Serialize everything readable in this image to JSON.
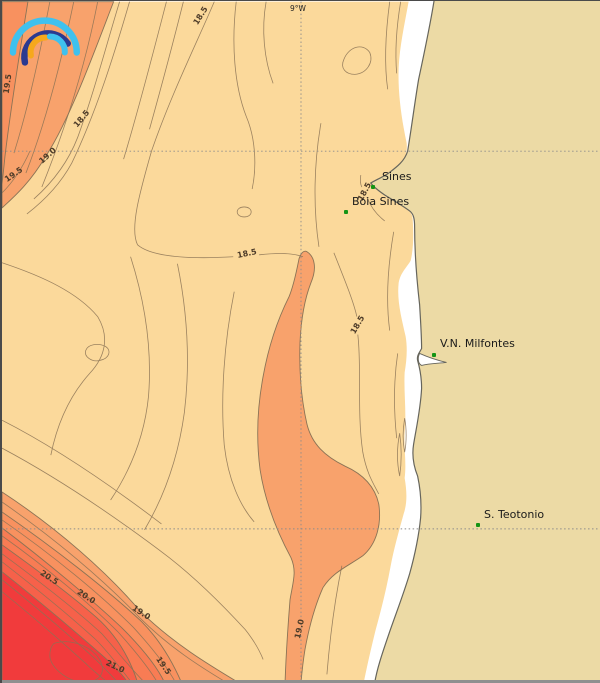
{
  "map": {
    "meridian_label": "9°W",
    "places": [
      {
        "name": "Sines",
        "marker_x": 371,
        "marker_y": 186,
        "label_x": 380,
        "label_y": 170
      },
      {
        "name": "Boia Sines",
        "marker_x": 344,
        "marker_y": 211,
        "label_x": 350,
        "label_y": 195
      },
      {
        "name": "V.N. Milfontes",
        "marker_x": 432,
        "marker_y": 354,
        "label_x": 438,
        "label_y": 337
      },
      {
        "name": "S. Teotonio",
        "marker_x": 476,
        "marker_y": 524,
        "label_x": 482,
        "label_y": 508
      }
    ],
    "contour_labels": [
      {
        "text": "19.5",
        "x": 6,
        "y": 83,
        "rot": -82
      },
      {
        "text": "18.5",
        "x": 199,
        "y": 15,
        "rot": -58
      },
      {
        "text": "18.5",
        "x": 80,
        "y": 118,
        "rot": -50
      },
      {
        "text": "19.0",
        "x": 46,
        "y": 155,
        "rot": -42
      },
      {
        "text": "19.5",
        "x": 12,
        "y": 174,
        "rot": -35
      },
      {
        "text": "18.5",
        "x": 245,
        "y": 253,
        "rot": -12
      },
      {
        "text": "18.5",
        "x": 363,
        "y": 191,
        "rot": -62
      },
      {
        "text": "18.5",
        "x": 356,
        "y": 324,
        "rot": -60
      },
      {
        "text": "20.5",
        "x": 47,
        "y": 577,
        "rot": 33
      },
      {
        "text": "20.0",
        "x": 84,
        "y": 596,
        "rot": 33
      },
      {
        "text": "19.0",
        "x": 139,
        "y": 612,
        "rot": 33
      },
      {
        "text": "21.0",
        "x": 113,
        "y": 666,
        "rot": 25
      },
      {
        "text": "19.5",
        "x": 161,
        "y": 665,
        "rot": 55
      },
      {
        "text": "19.0",
        "x": 298,
        "y": 628,
        "rot": -78
      }
    ],
    "colors": {
      "ocean_base": "#FBD99B",
      "band_19_0": "#F8A26C",
      "band_19_5": "#F8915F",
      "band_20_0": "#F87C54",
      "band_20_5": "#F6614A",
      "band_21_0": "#F13B3C",
      "land": "#ECDAA5",
      "nearshore_gap": "#FFFFFF",
      "coastline": "#66655C",
      "contour_line": "#8B7355",
      "grid_line": "#8C8C8C",
      "place_marker": "#159415",
      "label_text": "#1A1A1A",
      "contour_label_text": "#4D3B28"
    },
    "logo": {
      "icon": "rainbow-arcs-logo",
      "arc_colors": [
        "#3FC1EE",
        "#2B3990",
        "#F6A81C",
        "#3FC1EE"
      ]
    }
  }
}
